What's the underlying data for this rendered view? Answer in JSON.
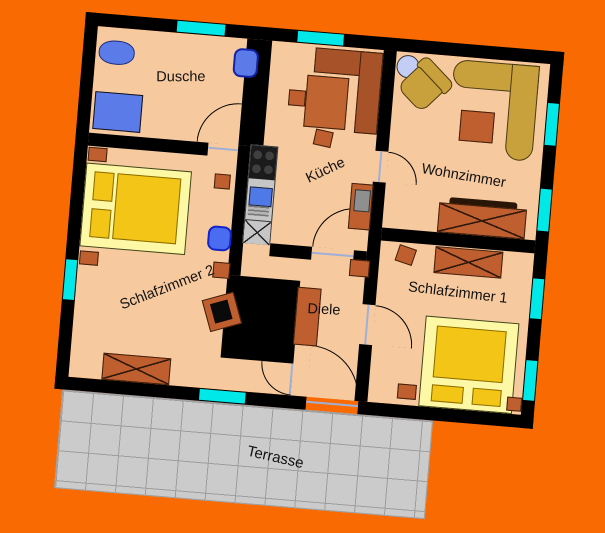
{
  "plan": {
    "title": "apartment-floor-plan",
    "rooms": [
      {
        "label": "Dusche"
      },
      {
        "label": "Küche"
      },
      {
        "label": "Wohnzimmer"
      },
      {
        "label": "Schlafzimmer 1"
      },
      {
        "label": "Schlafzimmer 2"
      },
      {
        "label": "Diele"
      },
      {
        "label": "Terrasse"
      }
    ],
    "colors": {
      "background": "#FA6A02",
      "floor": "#F7C99E",
      "wall": "#000000",
      "window": "#00E8E8",
      "furniture_wood": "#BF5F30",
      "bed_frame": "#FDF8A6",
      "bed_mattress": "#F3C516",
      "sofa": "#C8A03C",
      "bath_fixture": "#5B7BE8",
      "terrace_tile": "#CBCBCB"
    },
    "window_count": 8,
    "door_count": 6,
    "furniture": [
      "bathtub",
      "toilet",
      "shower",
      "corner-bench",
      "dining-table",
      "stools",
      "kitchen-unit-stove-sink-worktop",
      "kitchen-cabinet",
      "round-side-table",
      "armchair",
      "corner-sofa",
      "coffee-table",
      "tv-sideboard",
      "double-bed",
      "nightstands",
      "dressers",
      "wardrobe-block",
      "hall-shelf",
      "desk-chair",
      "laundry-basket"
    ]
  }
}
